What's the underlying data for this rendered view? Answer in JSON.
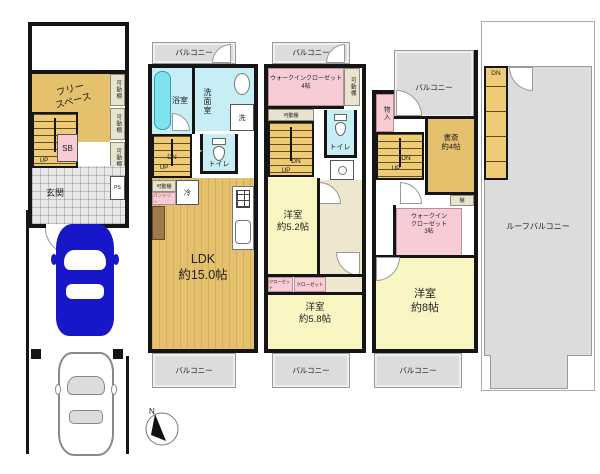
{
  "colors": {
    "tan": "#e5c16d",
    "stair_tan": "#eecb74",
    "pale_yellow": "#faf6c4",
    "pink": "#f7ccd4",
    "light_blue": "#c7edf5",
    "cyan": "#7fe3ef",
    "gray_balcony": "#dcdcdc",
    "shelf_beige": "#e7e3ce",
    "hall_beige": "#efe6cf",
    "car_blue": "#1717c9"
  },
  "floor1": {
    "free_space": "フリー\nスペース",
    "shelf_a": "可動棚",
    "shelf_b": "可動棚",
    "shelf_c": "可動棚",
    "shoe_box": "SB",
    "up": "UP",
    "entrance": "玄関",
    "ps": "PS"
  },
  "floor2": {
    "balcony_top": "バルコニー",
    "bath": "浴室",
    "washroom": "洗面室",
    "laundry": "洗",
    "toilet": "トイレ",
    "dn": "DN",
    "up": "UP",
    "shelf": "可動棚",
    "pantry": "パントリー",
    "fridge": "冷",
    "ldk": "LDK\n約15.0帖",
    "balcony_bottom": "バルコニー"
  },
  "floor3": {
    "balcony_top": "バルコニー",
    "wic": "ウォークインクローゼット\n4帖",
    "shelf_side": "可動棚",
    "shelf_under": "可動棚",
    "toilet": "トイレ",
    "dn": "DN",
    "up": "UP",
    "room_a": "洋室\n約5.2帖",
    "closet_a": "クローゼット",
    "closet_b": "クローゼット",
    "room_b": "洋室\n約5.8帖",
    "balcony_bottom": "バルコニー"
  },
  "floor4": {
    "storage": "物入",
    "balcony_top": "バルコニー",
    "study": "書斎\n約4帖",
    "dn": "DN",
    "up": "UP",
    "shelf": "棚",
    "wic": "ウォークイン\nクローゼット\n3帖",
    "room": "洋室\n約8帖",
    "balcony_bottom": "バルコニー"
  },
  "roof": {
    "dn": "DN",
    "label": "ルーフバルコニー"
  },
  "compass": {
    "north": "N"
  }
}
